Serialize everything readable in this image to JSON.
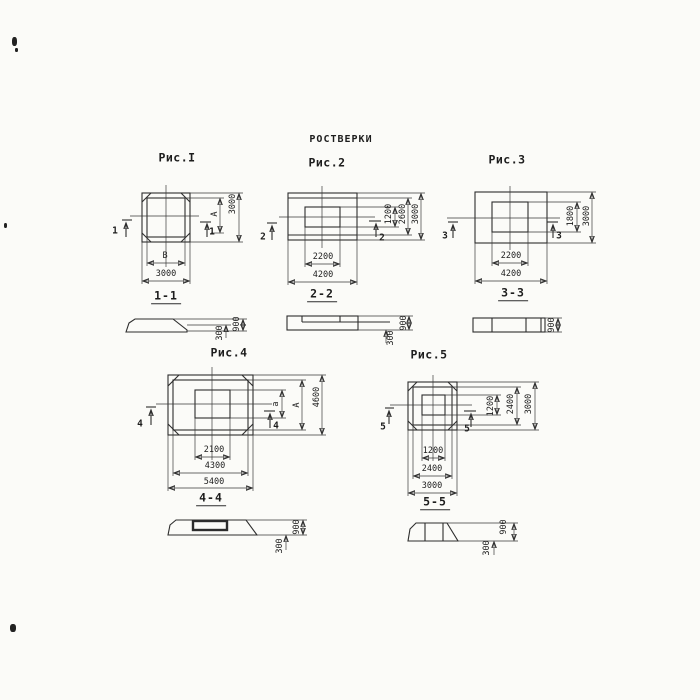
{
  "title": "РОСТВЕРКИ",
  "figures": {
    "fig1": {
      "label": "Рис.I",
      "cut": "1",
      "plan_dims": {
        "height_inner": "A",
        "height_outer": "3000",
        "width_inner": "B",
        "width_outer": "3000"
      },
      "section": {
        "label": "1-1",
        "step": "300",
        "height": "900"
      }
    },
    "fig2": {
      "label": "Рис.2",
      "cut": "2",
      "plan_dims": {
        "height_inner": "1200",
        "height_mid": "2600",
        "height_outer": "3000",
        "width_inner": "2200",
        "width_outer": "4200"
      },
      "section": {
        "label": "2-2",
        "step": "300",
        "height": "900"
      }
    },
    "fig3": {
      "label": "Рис.3",
      "cut": "3",
      "plan_dims": {
        "height_inner": "1800",
        "height_outer": "3000",
        "width_inner": "2200",
        "width_outer": "4200"
      },
      "section": {
        "label": "3-3",
        "height": "900"
      }
    },
    "fig4": {
      "label": "Рис.4",
      "cut": "4",
      "plan_dims": {
        "height_inner": "a",
        "height_mid": "A",
        "height_outer": "4600",
        "width_inner": "2100",
        "width_mid": "4300",
        "width_outer": "5400"
      },
      "section": {
        "label": "4-4",
        "step": "300",
        "height": "900"
      }
    },
    "fig5": {
      "label": "Рис.5",
      "cut": "5",
      "plan_dims": {
        "height_inner": "1200",
        "height_mid": "2400",
        "height_outer": "3000",
        "width_inner": "1200",
        "width_mid": "2400",
        "width_outer": "3000"
      },
      "section": {
        "label": "5-5",
        "step": "300",
        "height": "900"
      }
    }
  }
}
